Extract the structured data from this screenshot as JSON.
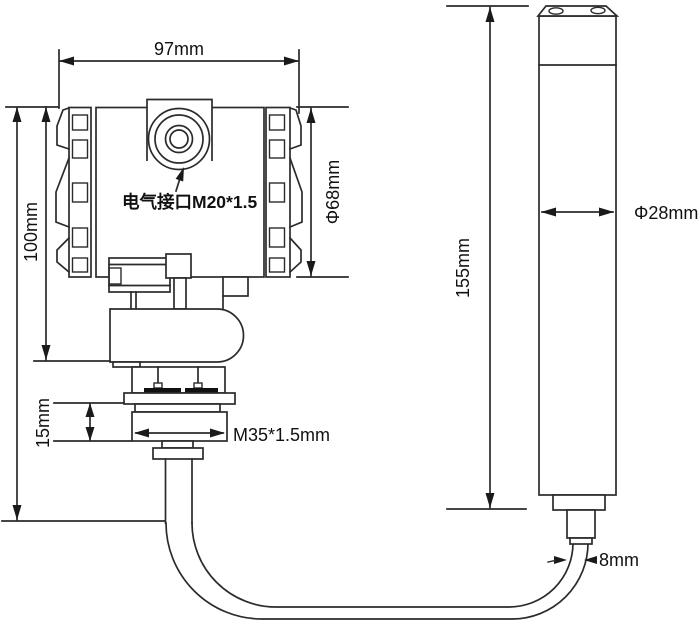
{
  "canvas": {
    "width": 700,
    "height": 629,
    "background": "#ffffff"
  },
  "colors": {
    "line": "#2b2b2b",
    "text": "#111111"
  },
  "labels": {
    "top_width": "97mm",
    "electrical_interface": "电气接口M20*1.5",
    "housing_diameter": "Φ68mm",
    "housing_height": "100mm",
    "thread_length": "15mm",
    "thread_spec": "M35*1.5mm",
    "probe_length": "155mm",
    "probe_diameter": "Φ28mm",
    "cable_diameter": "8mm"
  }
}
